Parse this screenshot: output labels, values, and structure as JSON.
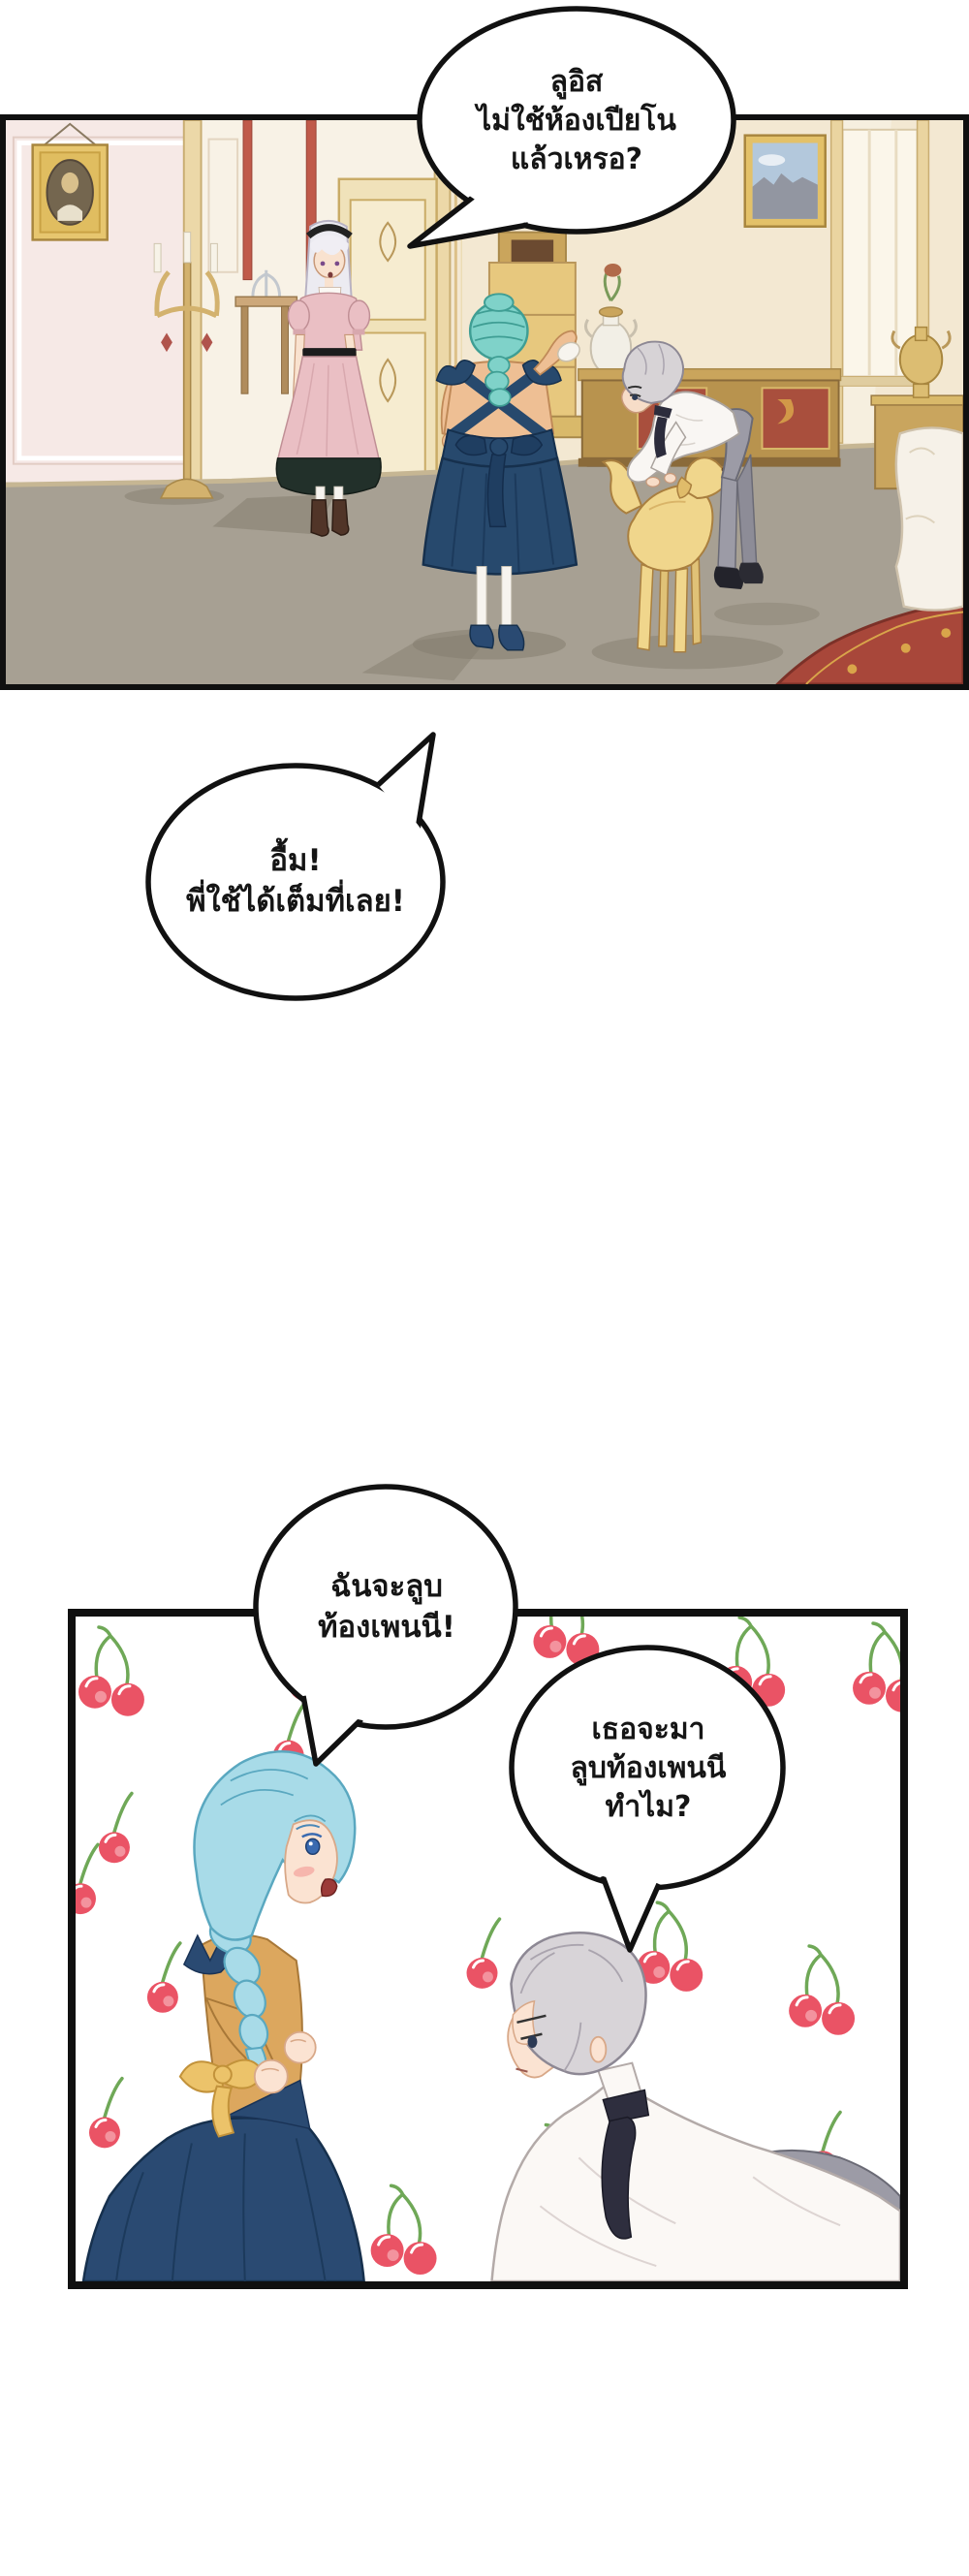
{
  "page": {
    "background": "#ffffff"
  },
  "bubbles": [
    {
      "id": "bubble-1",
      "tail": "bottom-left",
      "lines": [
        "ลูอิส",
        "ไม่ใช้ห้องเปียโน",
        "แล้วเหรอ?"
      ]
    },
    {
      "id": "bubble-2",
      "tail": "top-right",
      "lines": [
        "อื้ม!",
        "พี่ใช้ได้เต็มที่เลย!"
      ]
    },
    {
      "id": "bubble-3",
      "tail": "bottom-left",
      "lines": [
        "ฉันจะลูบ",
        "ท้องเพนนี!"
      ]
    },
    {
      "id": "bubble-4",
      "tail": "bottom",
      "lines": [
        "เธอจะมา",
        "ลูบท้องเพนนี",
        "ทำไม?"
      ]
    }
  ],
  "colors": {
    "outline": "#111111",
    "bubble_fill": "#ffffff",
    "cherry_red": "#ea5365",
    "cherry_highlight": "#f59fa8",
    "cherry_stem": "#6fa857",
    "navy_dress": "#2a4a72",
    "teal_hair": "#7fd2c9",
    "blue_hair": "#a8dbe8",
    "silver_hair": "#d7d3d6",
    "pink_dress": "#eabfc4",
    "pink_dress_hem": "#22302a",
    "mustard_blouse": "#dca75e",
    "bow_yellow": "#ecc36a",
    "gold_trim": "#d9b96a",
    "wall_cream": "#f3e8d2",
    "wall_pink": "#f6e9e6",
    "red_accent": "#c05a4a",
    "floor_taupe": "#a7a093",
    "carpet_red": "#a8473a",
    "dog_gold": "#f0d68c",
    "trousers_grey": "#9c9ba6"
  }
}
